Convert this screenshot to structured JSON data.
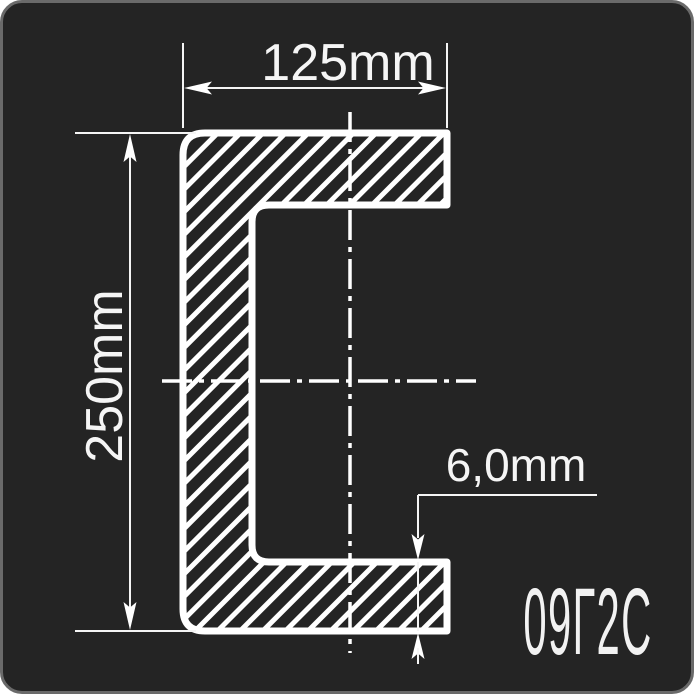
{
  "drawing": {
    "kind": "channel-section-cross-section",
    "labels": {
      "width": "125mm",
      "height": "250mm",
      "thickness": "6,0mm",
      "steel_grade": "09Г2С"
    },
    "colors": {
      "page_bg": "#ffffff",
      "card_bg": "#242424",
      "card_border": "#6a6a6a",
      "line": "#ffffff",
      "text": "#f5f5f5"
    }
  }
}
